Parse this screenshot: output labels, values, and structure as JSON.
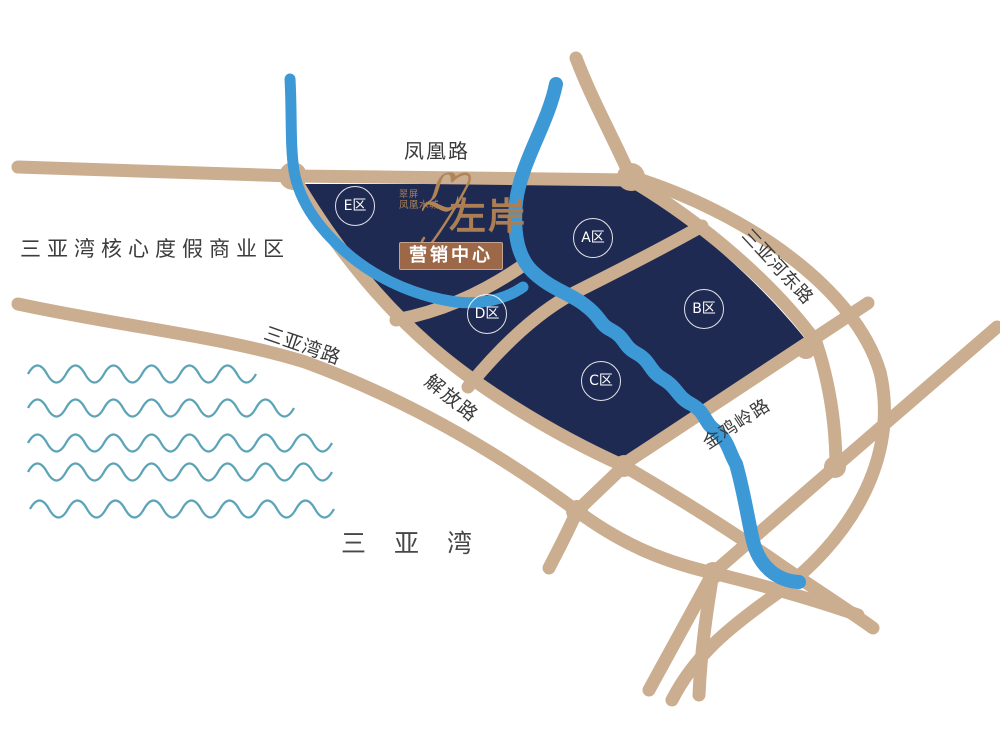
{
  "title": "翠屏凤凰水城左岸 营销中心 区位图",
  "logo": {
    "brand_small_line1": "翠屏",
    "brand_small_line2": "凤凰水城",
    "script_mark": "ℒ",
    "brand_main": "左岸",
    "marketing_center": "营销中心"
  },
  "roads": {
    "fenghuang": "凤凰路",
    "sanyawan": "三亚湾路",
    "jiefang": "解放路",
    "jinjiling": "金鸡岭路",
    "sanyahedong": "三亚河东路"
  },
  "areas": {
    "business_district": "三亚湾核心度假商业区",
    "bay": "三亚湾"
  },
  "zones": [
    {
      "label": "E区"
    },
    {
      "label": "A区"
    },
    {
      "label": "B区"
    },
    {
      "label": "C区"
    },
    {
      "label": "D区"
    }
  ],
  "colors": {
    "background": "#ffffff",
    "property_navy": "#1f2a52",
    "road_tan": "#cbad8f",
    "river_blue": "#3d99d6",
    "wave_teal": "#5ba4b8",
    "logo_bronze": "#ab7f53",
    "marketing_box_brown": "#9d6847",
    "label_dark": "#3a3a3a",
    "zone_text_white": "#ffffff"
  }
}
